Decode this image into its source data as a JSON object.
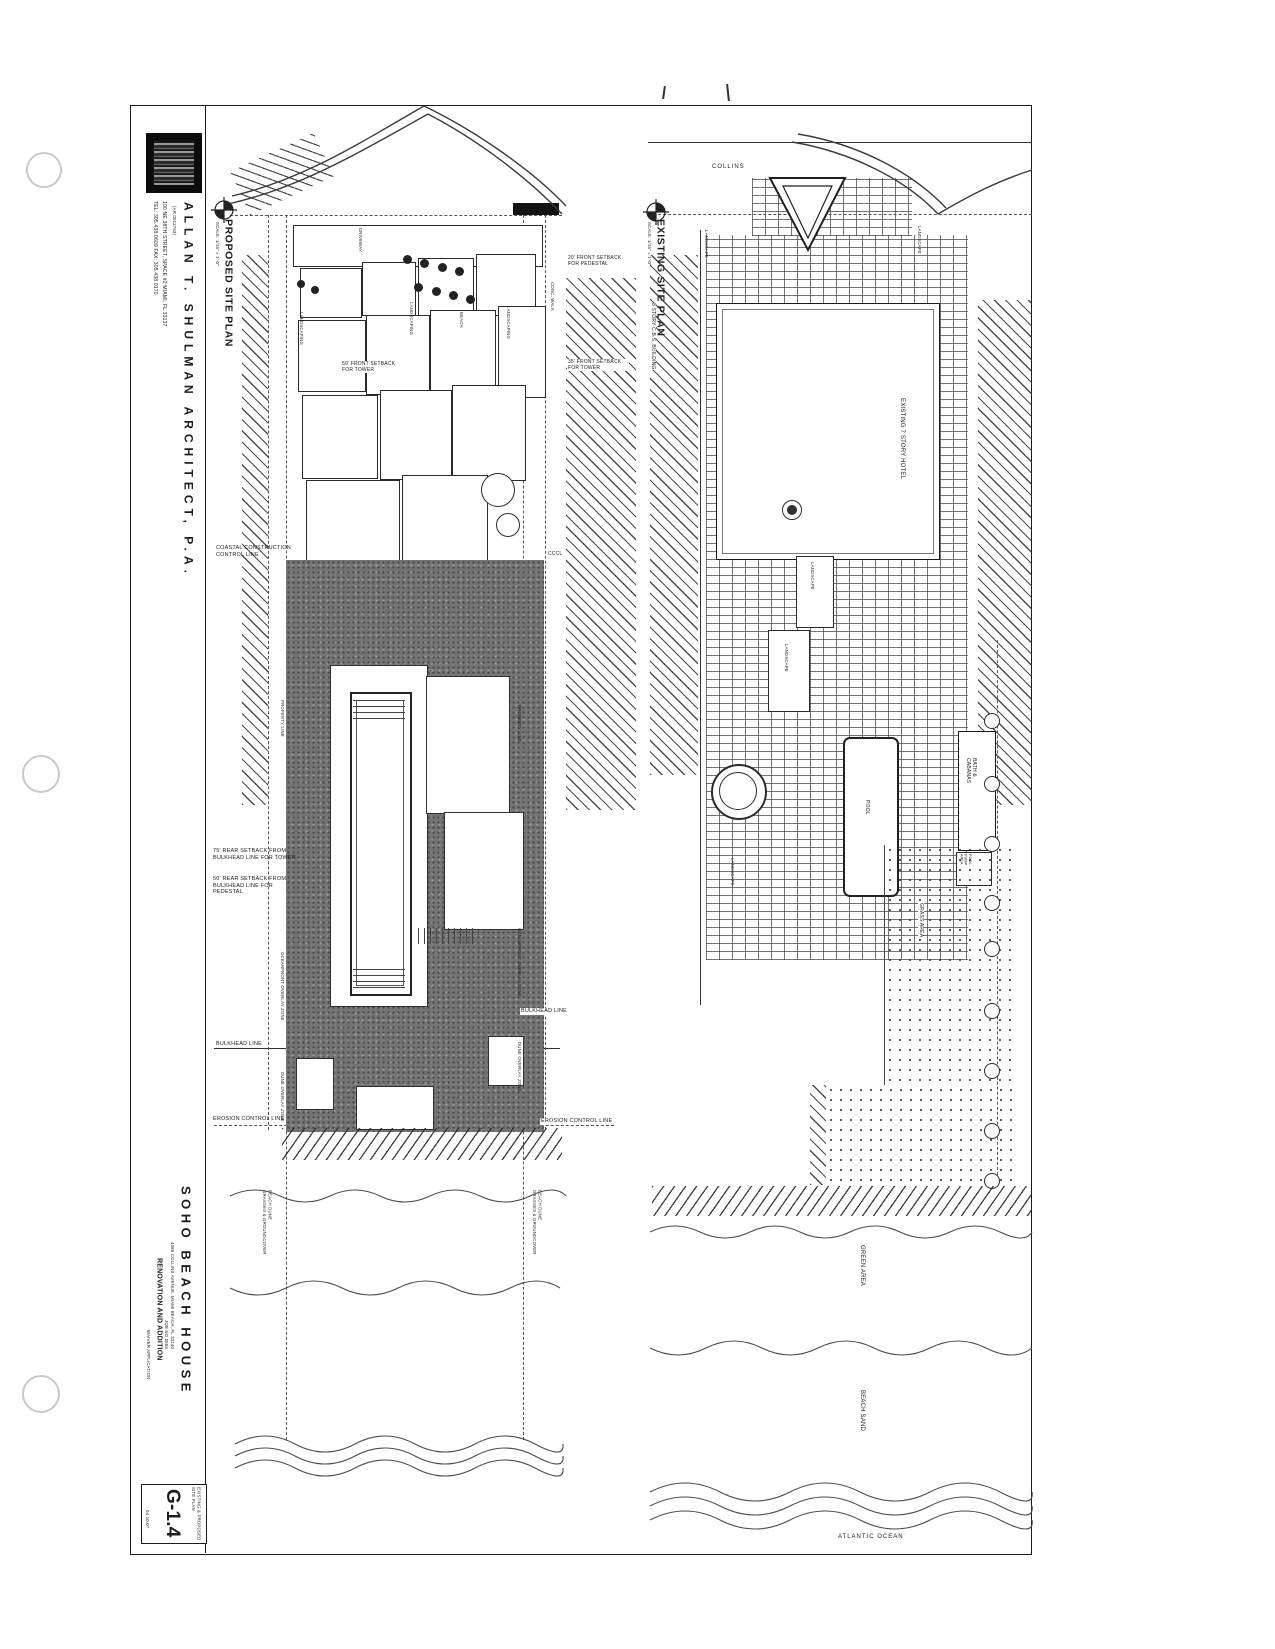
{
  "titleblock": {
    "architect": "ALLAN T. SHULMAN ARCHITECT, P.A.",
    "license": "(AR 0012763)",
    "address": "100 NE 38TH STREET, SPACE #2  MIAMI, FL 33137",
    "phone": "TEL: 305.438.0609  FAX: 305.438.0170",
    "project": "SOHO BEACH HOUSE",
    "project_address": "4385 COLLINS AVENUE, MIAMI BEACH, FL 33140",
    "job_no": "JOB NO 0506",
    "subtitle": "RENOVATION AND ADDITION",
    "application": "WAIVER APPLICATION",
    "sheet_title": "EXISTING & PROPOSED\nSITE PLAN",
    "sheet_number": "G-1.4",
    "sheet_date": "04.10.07"
  },
  "proposed": {
    "title": "PROPOSED SITE PLAN",
    "scale": "SCALE: 1/16\" = 1'-0\"",
    "labels": {
      "coastal": "COASTAL CONSTRUCTION\nCONTROL LINE",
      "cccl": "CCCL",
      "front_setback_pedestal": "20' FRONT SETBACK\nFOR PEDESTAL",
      "front_setback_tower_50": "50' FRONT SETBACK\nFOR TOWER",
      "front_setback_tower_35": "35' FRONT SETBACK\nFOR TOWER",
      "rear_setback_tower": "75' REAR SETBACK FROM\nBULKHEAD LINE FOR TOWER",
      "rear_setback_pedestal": "50' REAR SETBACK FROM\nBULKHEAD LINE FOR PEDESTAL",
      "bulkhead_left": "BULKHEAD LINE",
      "bulkhead_right": "BULKHEAD LINE",
      "erosion_left": "EROSION CONTROL LINE",
      "erosion_right": "EROSION CONTROL LINE",
      "property_line_left": "PROPERTY LINE",
      "property_line_right": "PROPERTY LINE",
      "oceanfront_left": "OCEANFRONT OVERLAY ZONE",
      "oceanfront_right": "OCEANFRONT OVERLAY ZONE",
      "dune_left": "DUNE OVERLAY ZONE",
      "dune_right": "DUNE OVERLAY ZONE",
      "beach_dune_left": "BEACH DUNE\nGRASSES & GROUNDCOVER",
      "beach_dune_right": "BEACH DUNE\nGRASSES & GROUNDCOVER",
      "landscaping_1": "LANDSCAPING",
      "landscaping_2": "LANDSCAPING",
      "landscaping_3": "LANDSCAPING",
      "beach": "BEACH",
      "driveway": "DRIVEWAY",
      "conc_walk": "CONC. WALK"
    }
  },
  "existing": {
    "title": "EXISTING SITE PLAN",
    "scale": "SCALE: 1/16\" = 1'-0\"",
    "labels": {
      "collins": "COLLINS",
      "cbs_building": "8 STORY C.B.S. BUILDING",
      "hotel": "EXISTING 7 STORY HOTEL",
      "landscape_top": "LANDSCAPE",
      "landscape_top_right": "LANDSCAPE",
      "landscape_mid_1": "LANDSCAPE",
      "landscape_mid_2": "LANDSCAPE",
      "landscape_left": "LANDSCAPE",
      "pool": "POOL",
      "bath_cabanas": "BATH &\nCABANAS",
      "pool_pump": "POOL\nPUMP\nAREA",
      "grass_area": "GRASS AREA",
      "green_area": "GREEN AREA",
      "beach_sand": "BEACH SAND",
      "ocean": "ATLANTIC OCEAN"
    }
  }
}
